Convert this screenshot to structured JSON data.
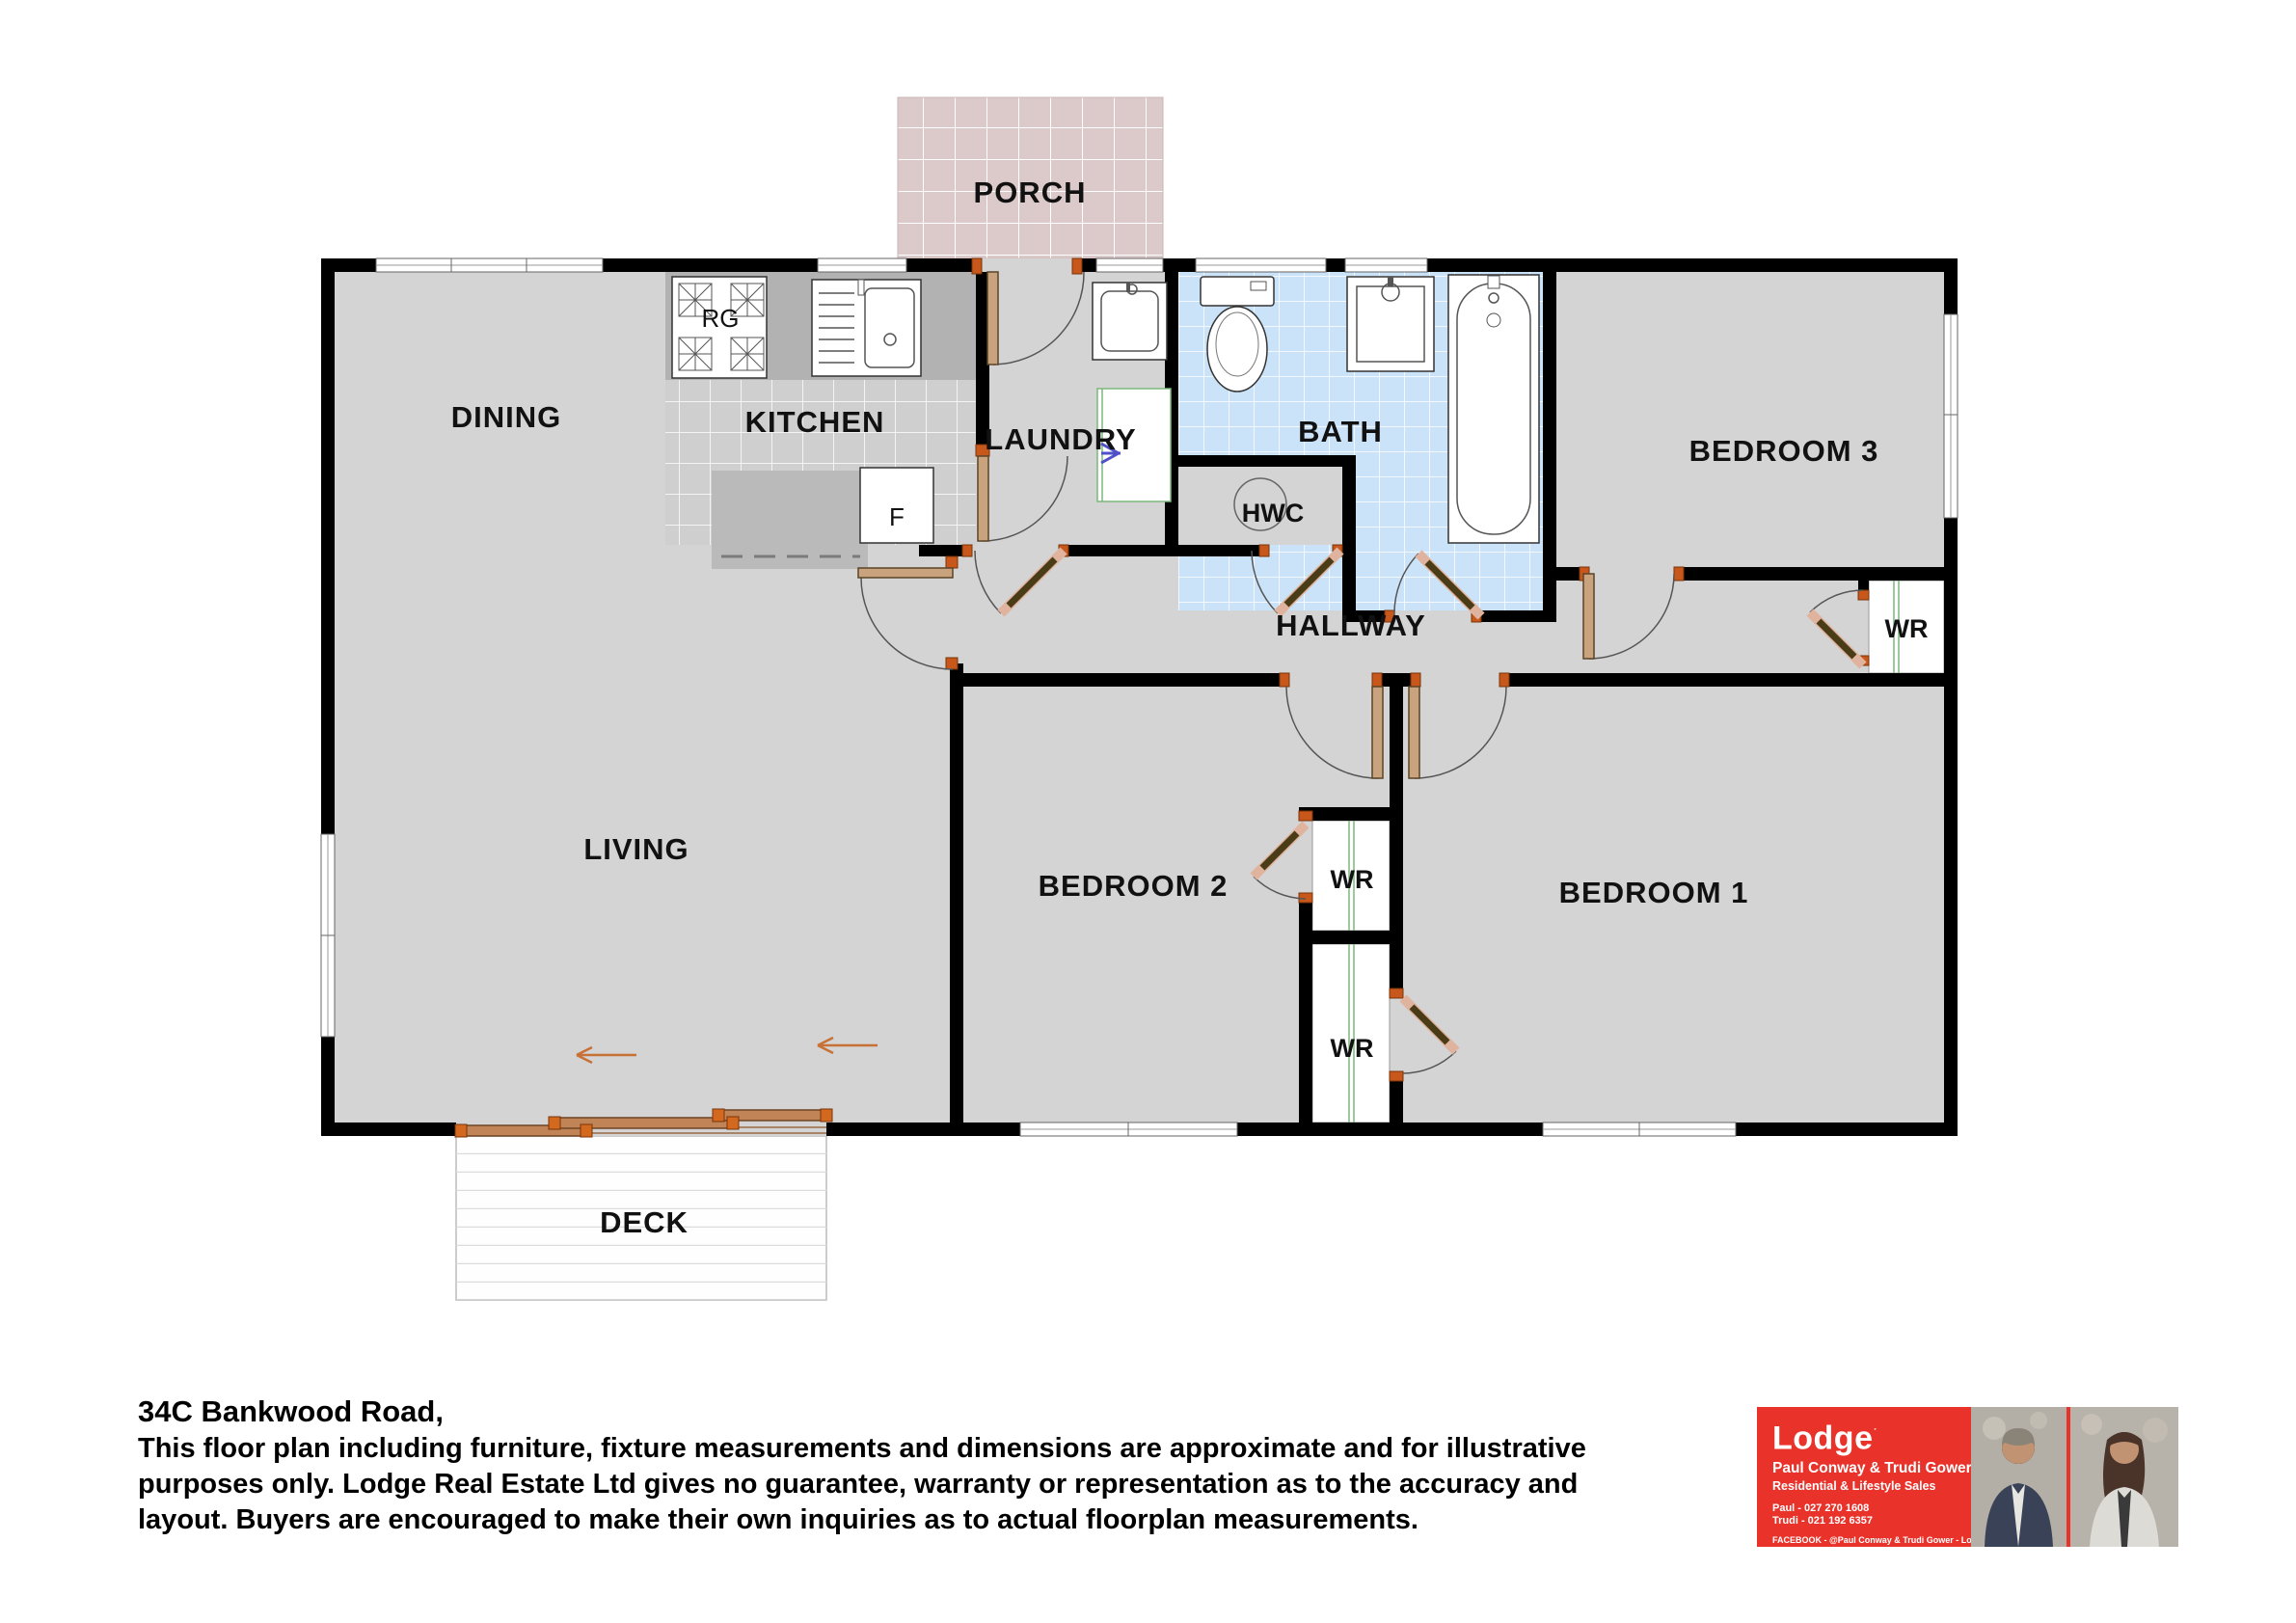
{
  "floorplan": {
    "rooms": {
      "porch": "PORCH",
      "dining": "DINING",
      "kitchen": "KITCHEN",
      "laundry": "LAUNDRY",
      "bath": "BATH",
      "bedroom3": "BEDROOM 3",
      "hwc": "HWC",
      "hallway": "HALLWAY",
      "living": "LIVING",
      "bedroom2": "BEDROOM 2",
      "bedroom1": "BEDROOM 1",
      "deck": "DECK",
      "wr_bed3": "WR",
      "wr_bed2_upper": "WR",
      "wr_bed2_lower": "WR"
    },
    "fixtures": {
      "range": "RG",
      "fridge": "F"
    },
    "colors": {
      "wall": "#000000",
      "floor": "#d4d4d4",
      "kitchen_floor": "#cfcfcf",
      "counter": "#b2b2b2",
      "island": "#bababa",
      "bath_floor": "#cbe3f8",
      "porch_floor": "#dccaca",
      "deck": "#fefefe",
      "door_frame": "#c8571c",
      "door_leaf": "#4a3c16",
      "wardrobe_track": "#7cb87c",
      "washer_mark": "#5050c8"
    }
  },
  "footer": {
    "address": "34C Bankwood Road,",
    "disclaimer_lines": [
      "This floor plan including furniture, fixture measurements and dimensions are approximate and for illustrative",
      "purposes only. Lodge Real Estate Ltd gives no guarantee, warranty or representation as to the accuracy and",
      "layout. Buyers are encouraged to make their own inquiries as to actual floorplan measurements."
    ]
  },
  "agent_card": {
    "brand": "Lodge",
    "agents": "Paul Conway & Trudi Gower",
    "division": "Residential & Lifestyle Sales",
    "phone1": "Paul - 027 270 1608",
    "phone2": "Trudi - 021 192 6357",
    "facebook": "FACEBOOK - @Paul Conway & Trudi Gower - Lodge Real Estate",
    "brand_color": "#e8322a"
  }
}
